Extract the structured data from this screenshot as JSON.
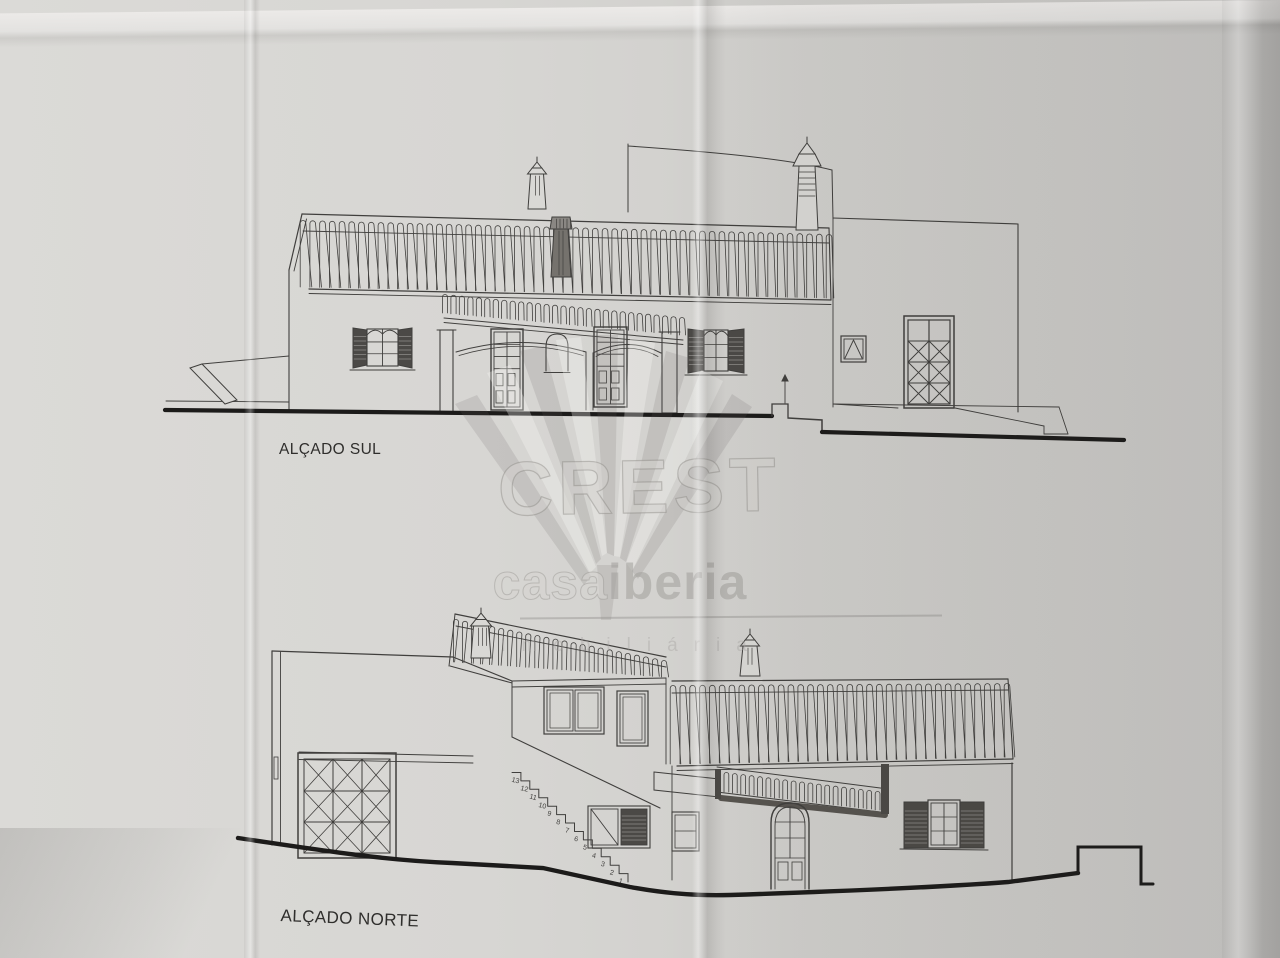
{
  "south": {
    "label": "ALÇADO SUL"
  },
  "north": {
    "label": "ALÇADO NORTE",
    "stair_numbers": [
      "13",
      "12",
      "11",
      "10",
      "9",
      "8",
      "7",
      "6",
      "5",
      "4",
      "3",
      "2",
      "1"
    ]
  },
  "watermark": {
    "title": "CREST",
    "brand_casa": "casa",
    "brand_iberia": "iberia",
    "subtitle": "imobiliária"
  },
  "colors": {
    "paper": "#d2d1cf",
    "ink": "#403f3d",
    "ink_heavy": "#1c1b1a",
    "shutter_dark": "#4b4946",
    "watermark_gray": "#b3b1ae"
  }
}
